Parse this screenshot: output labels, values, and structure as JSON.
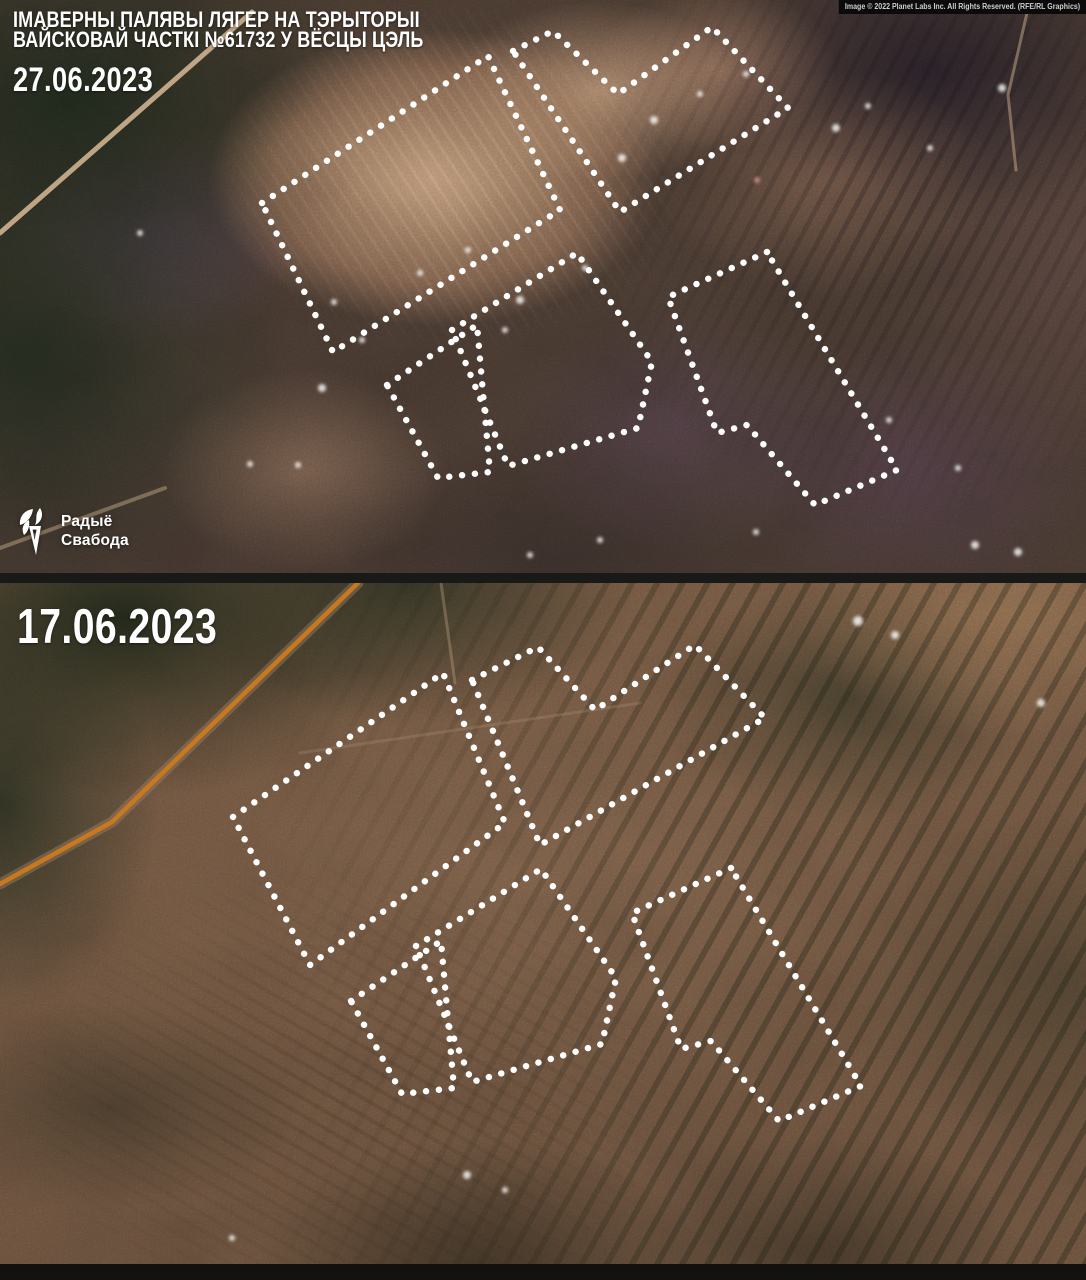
{
  "credit": "Image © 2022 Planet Labs Inc. All Rights Reserved. (RFE/RL Graphics)",
  "logo": {
    "line1": "Радыё",
    "line2": "Свабода"
  },
  "colors": {
    "outline": "#ffffff",
    "road_highlight": "#c9781e",
    "divider": "#191917"
  },
  "panels": [
    {
      "id": "after",
      "date": "27.06.2023",
      "title_line1": "ІМАВЕРНЫ ПАЛЯВЫ ЛЯГЕР НА ТЭРЫТОРЫІ",
      "title_line2": "ВАЙСКОВАЙ ЧАСТКІ №61732 У ВЁСЦЫ ЦЭЛЬ",
      "outlines": [
        [
          [
            262,
            203
          ],
          [
            488,
            56
          ],
          [
            560,
            210
          ],
          [
            333,
            352
          ]
        ],
        [
          [
            513,
            51
          ],
          [
            553,
            31
          ],
          [
            618,
            94
          ],
          [
            712,
            27
          ],
          [
            788,
            108
          ],
          [
            620,
            212
          ]
        ],
        [
          [
            452,
            330
          ],
          [
            577,
            253
          ],
          [
            652,
            362
          ],
          [
            638,
            428
          ],
          [
            508,
            466
          ]
        ],
        [
          [
            387,
            385
          ],
          [
            477,
            325
          ],
          [
            490,
            472
          ],
          [
            438,
            478
          ]
        ],
        [
          [
            767,
            252
          ],
          [
            668,
            297
          ],
          [
            717,
            433
          ],
          [
            747,
            425
          ],
          [
            815,
            505
          ],
          [
            897,
            470
          ]
        ]
      ],
      "roads": [
        {
          "points": [
            [
              252,
              12
            ],
            [
              0,
              233
            ]
          ],
          "color": "rgba(216,186,150,0.85)",
          "width": 5
        },
        {
          "points": [
            [
              0,
              548
            ],
            [
              165,
              488
            ]
          ],
          "color": "rgba(205,176,140,0.45)",
          "width": 4
        },
        {
          "points": [
            [
              1030,
              0
            ],
            [
              1008,
              95
            ],
            [
              1016,
              170
            ]
          ],
          "color": "rgba(200,172,140,0.5)",
          "width": 3
        }
      ],
      "spots": [
        [
          322,
          388,
          4
        ],
        [
          334,
          302,
          3
        ],
        [
          420,
          273,
          3
        ],
        [
          468,
          250,
          3
        ],
        [
          520,
          300,
          4
        ],
        [
          585,
          268,
          3
        ],
        [
          622,
          158,
          4
        ],
        [
          654,
          120,
          4
        ],
        [
          700,
          94,
          3
        ],
        [
          746,
          74,
          3
        ],
        [
          836,
          128,
          4
        ],
        [
          868,
          106,
          3
        ],
        [
          930,
          148,
          3
        ],
        [
          757,
          180,
          3,
          "#de9aa4"
        ],
        [
          975,
          545,
          4
        ],
        [
          1018,
          552,
          4
        ],
        [
          756,
          532,
          3
        ],
        [
          889,
          420,
          3
        ],
        [
          958,
          468,
          3
        ],
        [
          140,
          233,
          3
        ],
        [
          1002,
          88,
          4
        ],
        [
          250,
          464,
          3
        ],
        [
          298,
          465,
          3
        ],
        [
          530,
          555,
          3
        ],
        [
          600,
          540,
          3
        ],
        [
          362,
          340,
          3
        ],
        [
          505,
          330,
          3
        ]
      ]
    },
    {
      "id": "before",
      "date": "17.06.2023",
      "outlines": [
        [
          [
            233,
            234
          ],
          [
            443,
            90
          ],
          [
            505,
            240
          ],
          [
            310,
            382
          ]
        ],
        [
          [
            472,
            97
          ],
          [
            538,
            64
          ],
          [
            595,
            127
          ],
          [
            695,
            62
          ],
          [
            765,
            135
          ],
          [
            540,
            262
          ]
        ],
        [
          [
            416,
            363
          ],
          [
            541,
            286
          ],
          [
            616,
            395
          ],
          [
            602,
            461
          ],
          [
            472,
            499
          ]
        ],
        [
          [
            351,
            418
          ],
          [
            441,
            358
          ],
          [
            454,
            505
          ],
          [
            402,
            511
          ]
        ],
        [
          [
            731,
            285
          ],
          [
            632,
            330
          ],
          [
            681,
            466
          ],
          [
            711,
            458
          ],
          [
            779,
            538
          ],
          [
            861,
            503
          ]
        ]
      ],
      "roads": [
        {
          "points": [
            [
              358,
              0
            ],
            [
              112,
              239
            ],
            [
              0,
              301
            ]
          ],
          "color": "rgba(170,138,104,0.4)",
          "width": 11
        },
        {
          "points": [
            [
              358,
              0
            ],
            [
              112,
              239
            ],
            [
              0,
              301
            ]
          ],
          "color": "#c9781e",
          "width": 4.5
        },
        {
          "points": [
            [
              441,
              0
            ],
            [
              455,
              100
            ]
          ],
          "color": "rgba(200,170,135,0.35)",
          "width": 3
        },
        {
          "points": [
            [
              300,
              170
            ],
            [
              640,
              120
            ]
          ],
          "color": "rgba(195,166,132,0.22)",
          "width": 3
        }
      ],
      "spots": [
        [
          858,
          38,
          5
        ],
        [
          895,
          52,
          4
        ],
        [
          467,
          592,
          4
        ],
        [
          505,
          607,
          3
        ],
        [
          1041,
          120,
          4
        ],
        [
          232,
          655,
          3
        ]
      ]
    }
  ]
}
